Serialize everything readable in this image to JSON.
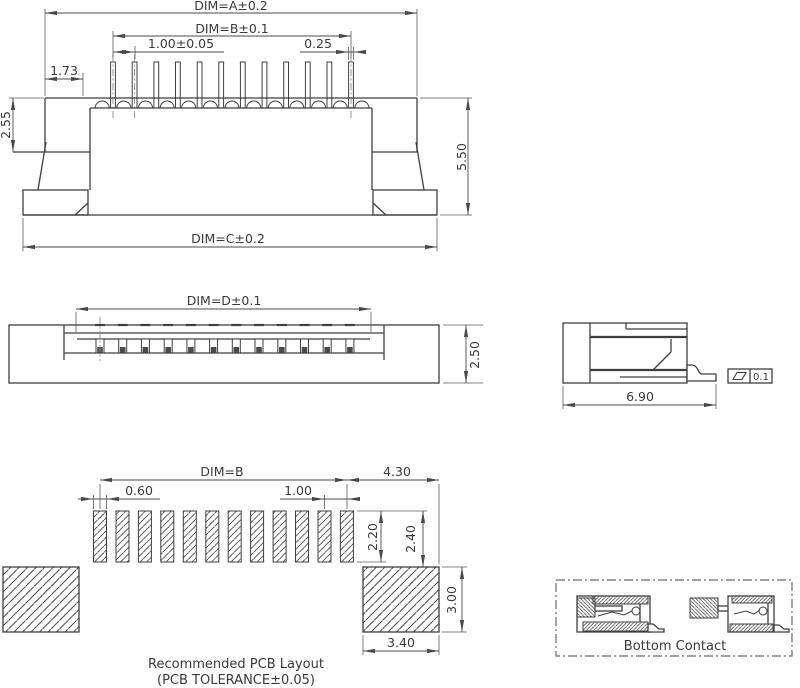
{
  "drawing": {
    "front_view": {
      "pin_count": 12,
      "dim_a": "DIM=A±0.2",
      "dim_b": "DIM=B±0.1",
      "contact_pitch": "1.00±0.05",
      "contact_width": "0.25",
      "edge_offset": "1.73",
      "shoulder_height": "2.55",
      "total_height": "5.50",
      "dim_c": "DIM=C±0.2"
    },
    "top_view": {
      "dim_d": "DIM=D±0.1",
      "body_height": "2.50"
    },
    "side_view": {
      "body_width": "6.90",
      "flatness_tolerance": "0.1"
    },
    "pcb_layout": {
      "pad_count": 12,
      "dim_b": "DIM=B",
      "anchor_offset": "4.30",
      "pad_width": "0.60",
      "pad_pitch": "1.00",
      "pad_length": "2.20",
      "pad_clearance": "2.40",
      "anchor_pad_height": "3.00",
      "anchor_pad_width": "3.40",
      "caption_line1": "Recommended PCB Layout",
      "caption_line2": "(PCB TOLERANCE±0.05)"
    },
    "bottom_contact": {
      "label": "Bottom Contact"
    },
    "colors": {
      "line": "#3f3f3f",
      "dim_line": "#4a4a4a",
      "text": "#3a3a3a",
      "background": "#ffffff"
    }
  }
}
